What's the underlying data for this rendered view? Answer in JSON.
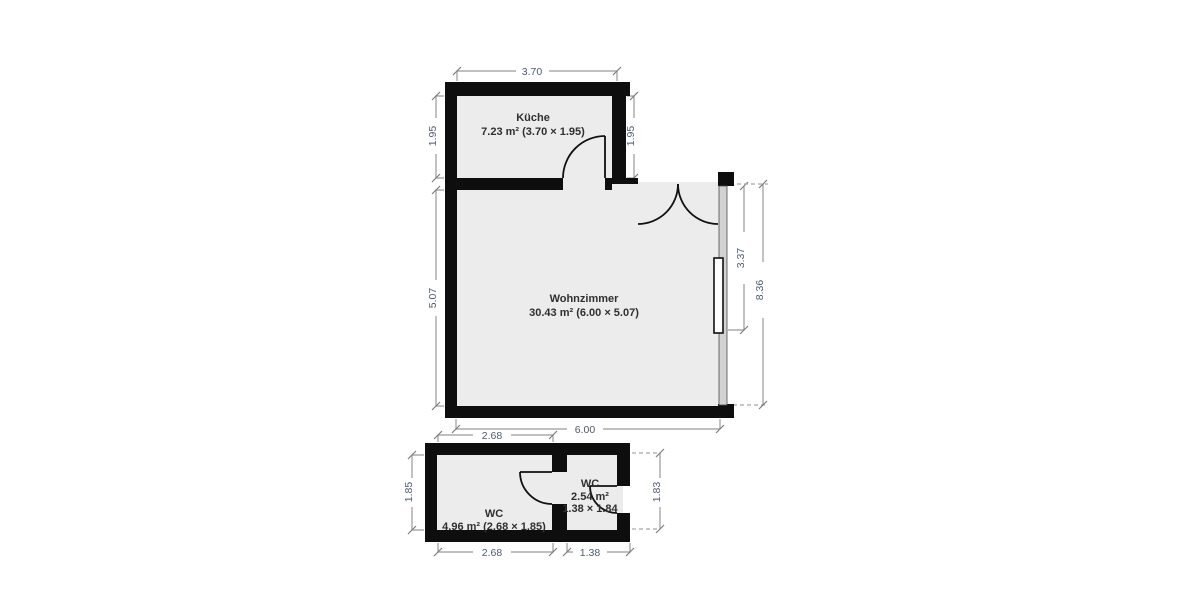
{
  "rooms": {
    "kueche": {
      "name": "Küche",
      "area": "7.23 m² (3.70 × 1.95)"
    },
    "wohnzimmer": {
      "name": "Wohnzimmer",
      "area": "30.43 m² (6.00 × 5.07)"
    },
    "wc": {
      "name": "WC",
      "area": "4.96 m² (2.68 × 1.85)"
    },
    "wc_klein": {
      "name": "WC",
      "area": "2.54 m²",
      "dims": "1.38 × 1.84"
    }
  },
  "dimensions": {
    "kueche_top": "3.70",
    "kueche_left": "1.95",
    "kueche_right": "1.95",
    "wohnzimmer_left": "5.07",
    "wohnzimmer_bottom": "6.00",
    "fenster_right": "3.37",
    "gesamt_right": "8.36",
    "wc_top": "2.68",
    "wc_bottom": "2.68",
    "wc_left": "1.85",
    "wc_klein_bottom": "1.38",
    "wc_klein_right": "1.83"
  },
  "colors": {
    "wall": "#0e0e0e",
    "floor": "#ececec",
    "dimension_line": "#9a9a9a",
    "dimension_text": "#4e5a6e",
    "room_text": "#2f2f2f",
    "window_wall": "#d2d2d2",
    "background": "#ffffff"
  }
}
